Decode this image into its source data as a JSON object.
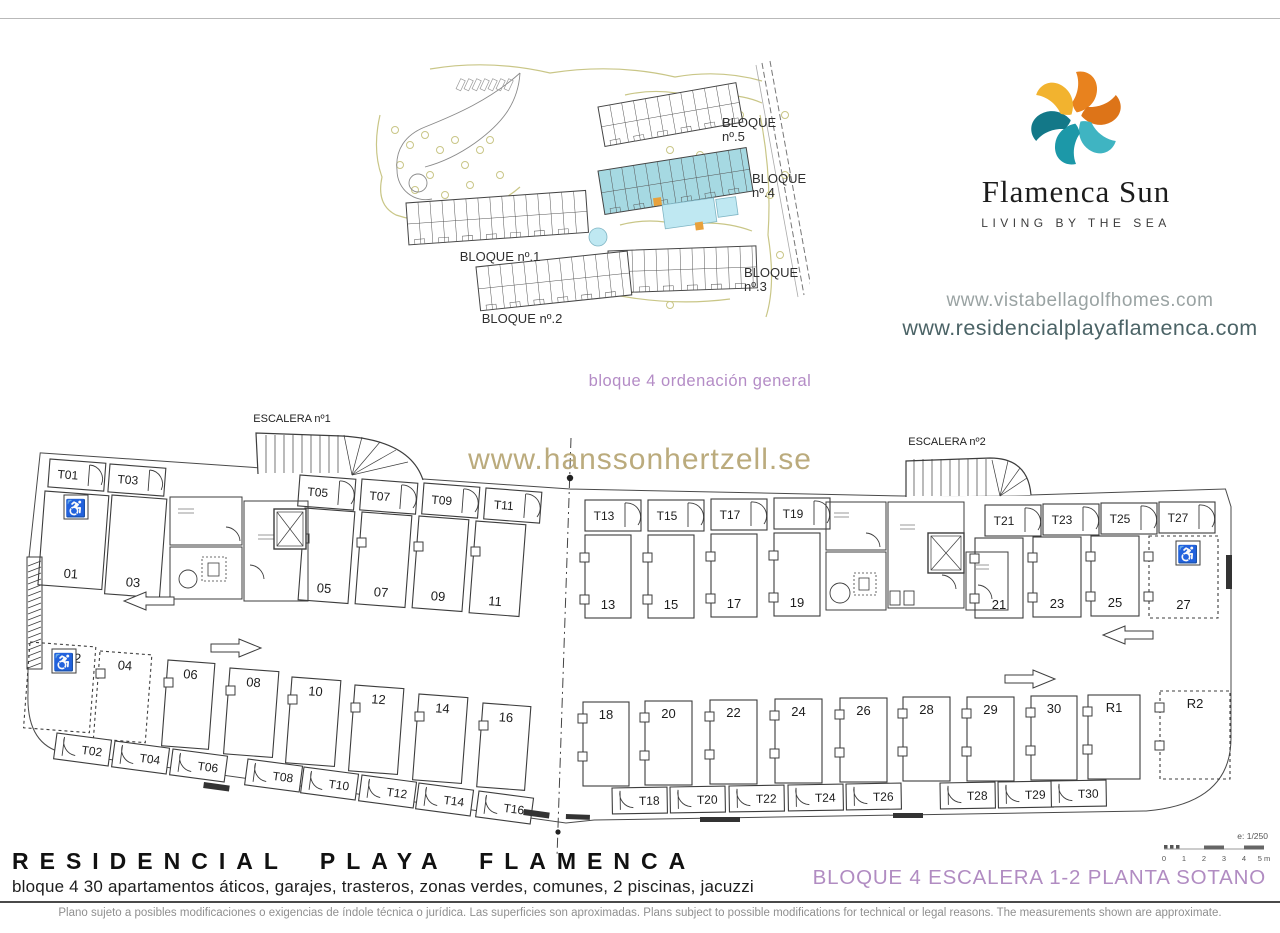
{
  "logo": {
    "brand": "Flamenca Sun",
    "tagline": "LIVING BY THE SEA"
  },
  "urls": {
    "url1": "www.vistabellagolfhomes.com",
    "url2": "www.residencialplayaflamenca.com"
  },
  "site_plan": {
    "caption": "bloque 4 ordenación general",
    "block_labels": [
      [
        "BLOQUE",
        "nº.5"
      ],
      [
        "BLOQUE",
        "nº.4"
      ],
      [
        "BLOQUE nº.1"
      ],
      [
        "BLOQUE",
        "nº.3"
      ],
      [
        "BLOQUE nº.2"
      ]
    ]
  },
  "floor_plan": {
    "watermark": "www.hanssonhertzell.se",
    "escalera1": "ESCALERA nº1",
    "escalera2": "ESCALERA nº2",
    "top_storage_left": [
      "T01",
      "T03"
    ],
    "top_storage": [
      "T05",
      "T07",
      "T09",
      "T11",
      "T13",
      "T15",
      "T17",
      "T19",
      "T21",
      "T23",
      "T25",
      "T27"
    ],
    "top_parking": [
      "01",
      "03",
      "05",
      "07",
      "09",
      "11",
      "13",
      "15",
      "17",
      "19",
      "21",
      "23",
      "25",
      "27"
    ],
    "bottom_parking": [
      "02",
      "04",
      "06",
      "08",
      "10",
      "12",
      "14",
      "16",
      "18",
      "20",
      "22",
      "24",
      "26",
      "28",
      "29",
      "30",
      "R1",
      "R2"
    ],
    "bottom_storage": [
      "T02",
      "T04",
      "T06",
      "T08",
      "T10",
      "T12",
      "T14",
      "T16",
      "T18",
      "T20",
      "T22",
      "T24",
      "T26",
      "T28",
      "T29",
      "T30"
    ],
    "scale_label": "e: 1/250",
    "scale_ticks": [
      "0",
      "1",
      "2",
      "3",
      "4",
      "5 m"
    ]
  },
  "footer": {
    "title": "RESIDENCIAL PLAYA FLAMENCA",
    "subtitle": "bloque 4 30 apartamentos áticos, garajes, trasteros, zonas verdes, comunes, 2 piscinas, jacuzzi",
    "sheet_title": "BLOQUE 4 ESCALERA 1-2 PLANTA SOTANO",
    "disclaimer": "Plano sujeto a posibles modificaciones o exigencias de índole técnica o jurídica. Las superficies son aproximadas. Plans subject to possible modifications for technical or legal reasons. The measurements shown are approximate."
  },
  "colors": {
    "accent_purple": "#b48cc6",
    "watermark_tan": "#b4a370",
    "url_gray": "#9aa3a3",
    "url_teal": "#4b6366",
    "plan_line": "#3d3d3d",
    "block4_highlight": "#a6d9e2",
    "pool_blue": "#bfe8f2",
    "vegetation": "#c9c687",
    "jacuzzi_orange": "#e8a13c",
    "logo_orange": "#E8821E",
    "logo_deep_orange": "#DD7418",
    "logo_yellow": "#F2B32F",
    "logo_teal_light": "#3FB4C2",
    "logo_teal": "#1C98A8",
    "logo_teal_dark": "#137888"
  }
}
